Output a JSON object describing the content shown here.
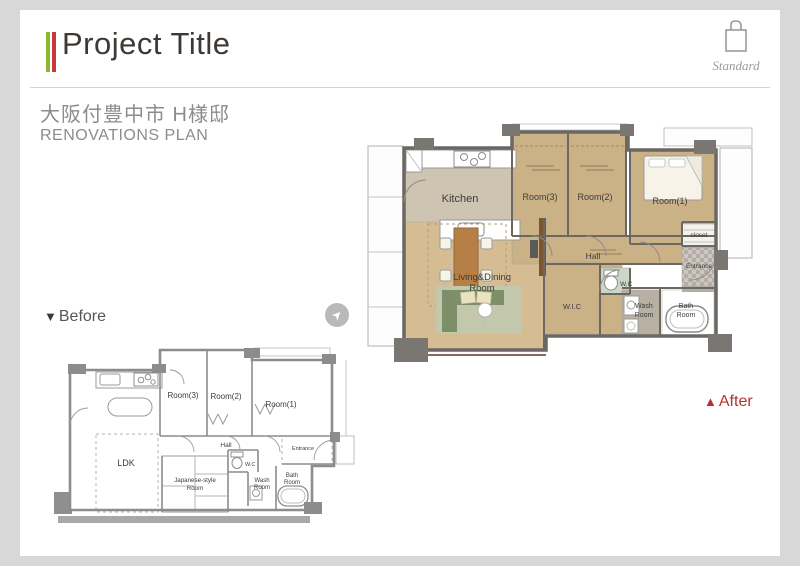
{
  "header": {
    "title": "Project Title",
    "badge": {
      "label": "Standard"
    }
  },
  "subtitle": {
    "location_jp": "大阪付豊中市 H様邸",
    "plan_en": "RENOVATIONS PLAN"
  },
  "nav": {
    "before_marker": "▼",
    "before_label": "Before",
    "after_marker": "▲",
    "after_label": "After",
    "arrow_glyph": "➤"
  },
  "colors": {
    "accent_green": "#8ab82e",
    "accent_red": "#c9393c",
    "after_accent": "#b5312c",
    "floor_tan": "#cbb186",
    "floor_kitchen": "#cdc4b2",
    "floor_living": "#d5bc92",
    "wall_dark": "#6b6763",
    "before_wall": "#8c8c8c",
    "sofa_green": "#7d8f68",
    "rug_green": "#c3c7ab",
    "wood_table": "#b57f45",
    "wood_wall": "#7a5634",
    "wc_floor": "#ccd7c7",
    "wash_floor": "#b8b0a3"
  },
  "after_plan": {
    "rooms": {
      "kitchen": "Kitchen",
      "room3": "Room(3)",
      "room2": "Room(2)",
      "room1": "Room(1)",
      "closet": "closet",
      "hall": "Hall",
      "living_line1": "Living&Dining",
      "living_line2": "Room",
      "wic": "W.I.C",
      "wc": "W.C",
      "wash_line1": "Wash",
      "wash_line2": "Room",
      "bath_line1": "Bath",
      "bath_line2": "Room",
      "entrance": "Entrance"
    }
  },
  "before_plan": {
    "rooms": {
      "room3": "Room(3)",
      "room2": "Room(2)",
      "room1": "Room(1)",
      "hall": "Hall",
      "ldk": "LDK",
      "japanese_line1": "Japanese-style",
      "japanese_line2": "Room",
      "wc": "W.C",
      "wash_line1": "Wash",
      "wash_line2": "Room",
      "bath_line1": "Bath",
      "bath_line2": "Room",
      "entrance": "Entrance"
    }
  }
}
